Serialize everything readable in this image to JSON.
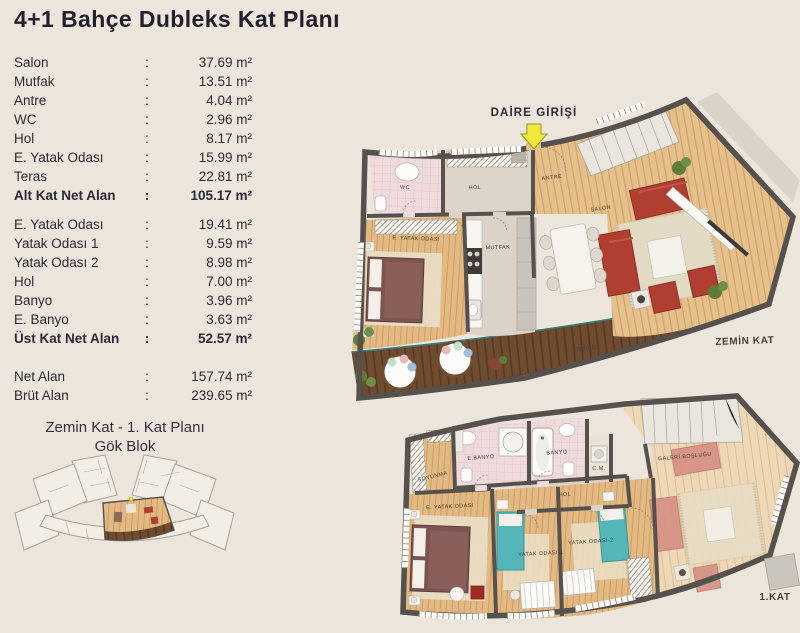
{
  "page": {
    "title": "4+1 Bahçe Dubleks Kat Planı"
  },
  "area_table": {
    "separator": ":",
    "lower_floor_rows": [
      {
        "label": "Salon",
        "value": "37.69 m²"
      },
      {
        "label": "Mutfak",
        "value": "13.51 m²"
      },
      {
        "label": "Antre",
        "value": "4.04 m²"
      },
      {
        "label": "WC",
        "value": "2.96 m²"
      },
      {
        "label": "Hol",
        "value": "8.17 m²"
      },
      {
        "label": "E. Yatak Odası",
        "value": "15.99 m²"
      },
      {
        "label": "Teras",
        "value": "22.81 m²"
      },
      {
        "label": "Alt Kat Net Alan",
        "value": "105.17 m²",
        "bold": true
      }
    ],
    "upper_floor_rows": [
      {
        "label": "E. Yatak Odası",
        "value": "19.41 m²"
      },
      {
        "label": "Yatak Odası 1",
        "value": "9.59 m²"
      },
      {
        "label": "Yatak Odası 2",
        "value": "8.98 m²"
      },
      {
        "label": "Hol",
        "value": "7.00 m²"
      },
      {
        "label": "Banyo",
        "value": "3.96 m²"
      },
      {
        "label": "E. Banyo",
        "value": "3.63 m²"
      },
      {
        "label": "Üst Kat Net Alan",
        "value": "52.57 m²",
        "bold": true
      }
    ],
    "total_rows": [
      {
        "label": "Net Alan",
        "value": "157.74 m²"
      },
      {
        "label": "Brüt Alan",
        "value": "239.65 m²"
      }
    ]
  },
  "key_plan": {
    "caption_line1": "Zemin Kat - 1. Kat Planı",
    "caption_line2": "Gök Blok"
  },
  "ground_floor_plan": {
    "entrance_label": "DAİRE GİRİŞİ",
    "floor_label": "ZEMİN KAT",
    "room_labels": {
      "wc": "WC",
      "hol": "HOL",
      "antre": "ANTRE",
      "salon": "SALON",
      "master_bedroom": "E. YATAK ODASI",
      "kitchen": "MUTFAK",
      "terrace": "TERAS"
    }
  },
  "first_floor_plan": {
    "floor_label": "1.KAT",
    "room_labels": {
      "dressing": "SOYUNMA",
      "master_bath": "E.BANYO",
      "bath": "BANYO",
      "laundry": "C.M.",
      "hall": "HOL",
      "gallery_void": "GALERİ BOŞLUĞU",
      "master_bedroom": "E. YATAK ODASI",
      "bedroom1": "YATAK ODASI-1",
      "bedroom2": "YATAK ODASI-2"
    }
  },
  "colors": {
    "background": "#EBE5DC",
    "text": "#2B2A36",
    "wall": "#56514C",
    "wood_floor": "#E5BF8C",
    "terrace_deck": "#6F4B30",
    "sofa_red": "#B03E31",
    "bed_teal": "#55B6BA",
    "bath_pink": "#F0DBDC",
    "entrance_arrow": "#F3E93C",
    "glass_line": "#2E7F7A"
  }
}
